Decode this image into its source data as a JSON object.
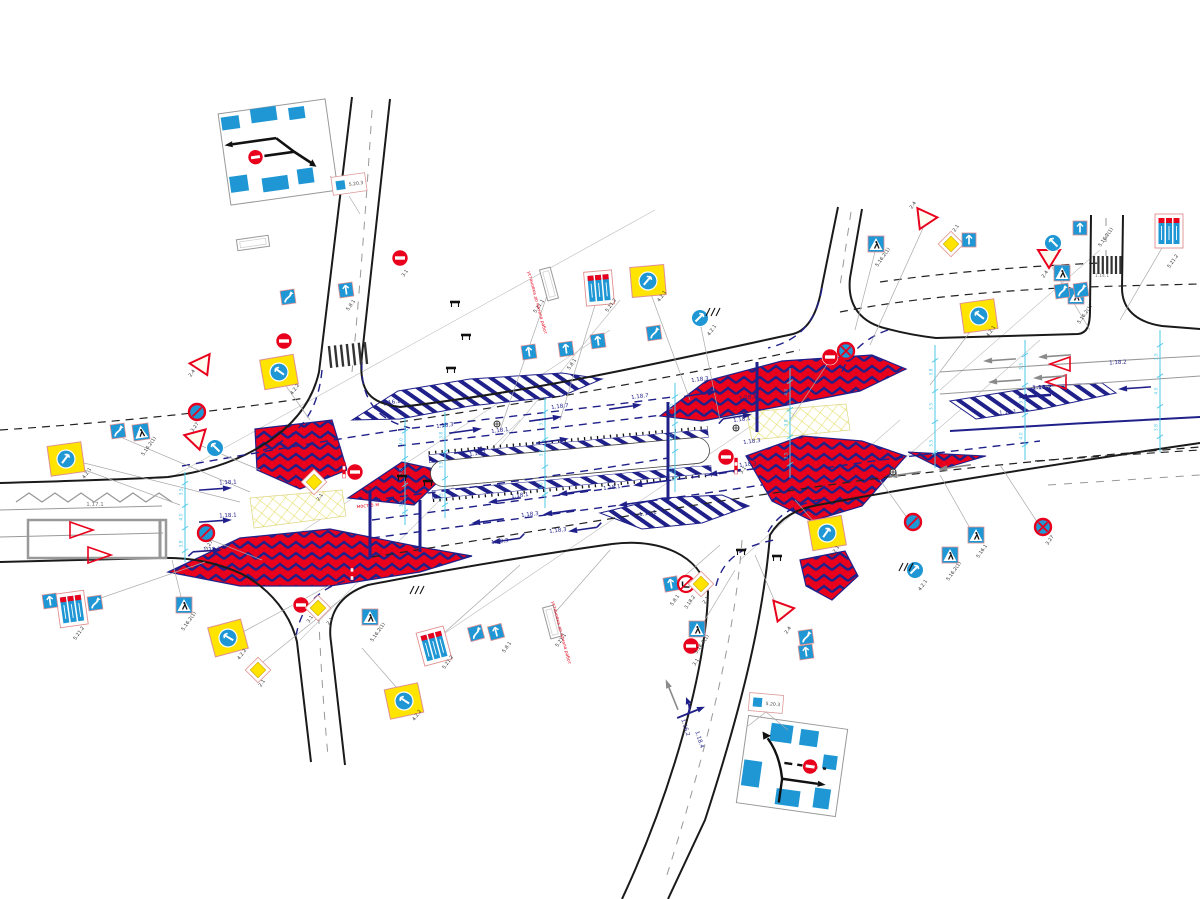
{
  "colors": {
    "navy": "#20208a",
    "red": "#e8001c",
    "yellow": "#ffe400",
    "sign_blue": "#1f97d4",
    "cyan": "#4ec8e8",
    "gray": "#8a8a8a"
  },
  "insets": {
    "top_left": {
      "code": "5.20.3"
    },
    "bottom_right": {
      "code": "5.20.3"
    }
  },
  "notes": [
    {
      "t": "мост 5 м",
      "x": 368,
      "y": 507,
      "c": "r",
      "r": -6,
      "s": 5
    },
    {
      "t": "мост 5 м",
      "x": 320,
      "y": 572,
      "c": "r",
      "r": -6,
      "s": 5
    },
    {
      "t": "установка до начала работ",
      "x": 560,
      "y": 633,
      "c": "r",
      "r": 75,
      "s": 4.5
    },
    {
      "t": "установка до начала работ",
      "x": 536,
      "y": 303,
      "c": "r",
      "r": 75,
      "s": 4.5
    }
  ],
  "signs": [
    {
      "t": "wv",
      "c": "5.8.1",
      "x": 288,
      "y": 297,
      "r": -8
    },
    {
      "t": "ba",
      "c": "5.8.1",
      "x": 346,
      "y": 290,
      "r": -8
    },
    {
      "t": "ne",
      "c": "3.1",
      "x": 400,
      "y": 258
    },
    {
      "t": "ne",
      "c": "3.1",
      "x": 284,
      "y": 341
    },
    {
      "t": "gw",
      "c": "2.4",
      "x": 203,
      "y": 366,
      "r": -25
    },
    {
      "t": "bs",
      "c": "3.27",
      "x": 197,
      "y": 412
    },
    {
      "t": "gw",
      "c": "2.4",
      "x": 197,
      "y": 440,
      "r": -15
    },
    {
      "t": "bc",
      "c": "4.2.2",
      "x": 215,
      "y": 448,
      "d": "left"
    },
    {
      "t": "yb",
      "c": "4.2.2",
      "x": 279,
      "y": 372,
      "r": -10,
      "d": "left"
    },
    {
      "t": "ped",
      "c": "5.16.2(1)",
      "x": 141,
      "y": 432,
      "r": -8
    },
    {
      "t": "yb",
      "c": "4.2.1",
      "x": 66,
      "y": 459,
      "r": -8,
      "d": "right"
    },
    {
      "t": "bs",
      "c": "3.27",
      "x": 206,
      "y": 533
    },
    {
      "t": "wv",
      "c": "5.8.1",
      "x": 118,
      "y": 431,
      "r": -8
    },
    {
      "t": "p3",
      "c": "5.21.2",
      "x": 72,
      "y": 609,
      "r": -8
    },
    {
      "t": "wv",
      "c": "5.8.1",
      "x": 95,
      "y": 603,
      "r": -8
    },
    {
      "t": "ba",
      "c": "5.8.1",
      "x": 50,
      "y": 601,
      "r": -8
    },
    {
      "t": "ped",
      "c": "5.16.2(1)",
      "x": 184,
      "y": 605
    },
    {
      "t": "yb",
      "c": "4.2.2",
      "x": 228,
      "y": 638,
      "r": -15,
      "d": "left"
    },
    {
      "t": "dia",
      "c": "2.1",
      "x": 258,
      "y": 670
    },
    {
      "t": "ne",
      "c": "3.1",
      "x": 301,
      "y": 605
    },
    {
      "t": "dia",
      "c": "2.1",
      "x": 318,
      "y": 608
    },
    {
      "t": "yb",
      "c": "4.2.2",
      "x": 404,
      "y": 701,
      "r": -12,
      "d": "left"
    },
    {
      "t": "ped",
      "c": "5.16.2(1)",
      "x": 370,
      "y": 617
    },
    {
      "t": "p3",
      "c": "5.21.2",
      "x": 434,
      "y": 646,
      "r": -15
    },
    {
      "t": "wv",
      "c": "5.8.1",
      "x": 476,
      "y": 633,
      "r": -15
    },
    {
      "t": "ba",
      "c": "5.8.1",
      "x": 496,
      "y": 632,
      "r": -15
    },
    {
      "t": "wb",
      "c": "5.21.1",
      "x": 552,
      "y": 622,
      "r": 75
    },
    {
      "t": "ne",
      "c": "3.1",
      "x": 355,
      "y": 472
    },
    {
      "t": "post",
      "x": 344,
      "y": 470
    },
    {
      "t": "post",
      "x": 352,
      "y": 572
    },
    {
      "t": "dia",
      "c": "2.1",
      "x": 314,
      "y": 482
    },
    {
      "t": "wb",
      "c": "5.21.1",
      "x": 549,
      "y": 284,
      "r": 75
    },
    {
      "t": "p3",
      "c": "5.21.2",
      "x": 599,
      "y": 288,
      "r": -5
    },
    {
      "t": "yb",
      "c": "4.2.1",
      "x": 648,
      "y": 281,
      "r": -5,
      "d": "right"
    },
    {
      "t": "ba",
      "c": "5.8.1",
      "x": 529,
      "y": 352,
      "r": -8
    },
    {
      "t": "ba",
      "c": "5.8.1",
      "x": 566,
      "y": 349,
      "r": -8
    },
    {
      "t": "ba",
      "c": "5.8.1",
      "x": 598,
      "y": 341,
      "r": -8
    },
    {
      "t": "wv",
      "c": "5.8.1",
      "x": 654,
      "y": 333,
      "r": -8
    },
    {
      "t": "bc",
      "c": "4.2.1",
      "x": 700,
      "y": 318,
      "d": "right"
    },
    {
      "t": "ne",
      "c": "3.1",
      "x": 830,
      "y": 357
    },
    {
      "t": "ns",
      "c": "3.27",
      "x": 846,
      "y": 351
    },
    {
      "t": "ped",
      "c": "5.16.2(1)",
      "x": 876,
      "y": 244
    },
    {
      "t": "gw",
      "c": "2.4",
      "x": 924,
      "y": 220,
      "r": 25
    },
    {
      "t": "dia",
      "c": "2.1",
      "x": 951,
      "y": 244
    },
    {
      "t": "ba",
      "c": "5.8.1",
      "x": 969,
      "y": 240
    },
    {
      "t": "gw",
      "c": "2.4",
      "x": 1049,
      "y": 258
    },
    {
      "t": "bc",
      "c": "4.2.2",
      "x": 1053,
      "y": 243,
      "d": "left"
    },
    {
      "t": "ba",
      "c": "5.8.1",
      "x": 1080,
      "y": 228
    },
    {
      "t": "ped",
      "c": "5.16.2(1)",
      "x": 1062,
      "y": 273
    },
    {
      "t": "ped",
      "c": "5.16.2(1)",
      "x": 1076,
      "y": 296
    },
    {
      "t": "p3",
      "c": "5.21.2",
      "x": 1169,
      "y": 231
    },
    {
      "t": "yb",
      "c": "4.2.1",
      "x": 979,
      "y": 316,
      "r": -8,
      "d": "left"
    },
    {
      "t": "wv",
      "c": "5.8.1",
      "x": 1062,
      "y": 291,
      "r": -8
    },
    {
      "t": "wv",
      "c": "5.8.1",
      "x": 1081,
      "y": 290,
      "r": -8
    },
    {
      "t": "ne",
      "c": "3.1",
      "x": 726,
      "y": 457
    },
    {
      "t": "post",
      "x": 736,
      "y": 466
    },
    {
      "t": "yb",
      "c": "4.2.1",
      "x": 827,
      "y": 533,
      "r": -10,
      "d": "right"
    },
    {
      "t": "bs",
      "c": "3.27",
      "x": 913,
      "y": 522
    },
    {
      "t": "bc",
      "c": "4.2.1",
      "x": 915,
      "y": 570,
      "d": "right"
    },
    {
      "t": "ped",
      "c": "5.16.1",
      "x": 976,
      "y": 535
    },
    {
      "t": "ped",
      "c": "5.16.2(1)",
      "x": 950,
      "y": 555
    },
    {
      "t": "ns",
      "c": "3.27",
      "x": 1043,
      "y": 527
    },
    {
      "t": "ba",
      "c": "5.8.1",
      "x": 671,
      "y": 584,
      "r": -10
    },
    {
      "t": "nt",
      "c": "3.18.2",
      "x": 686,
      "y": 584
    },
    {
      "t": "dia",
      "c": "2.1",
      "x": 701,
      "y": 584
    },
    {
      "t": "ped",
      "c": "5.16.2(1)",
      "x": 697,
      "y": 629
    },
    {
      "t": "ne",
      "c": "3.1",
      "x": 691,
      "y": 646
    },
    {
      "t": "gw",
      "c": "2.4",
      "x": 781,
      "y": 612,
      "r": 20
    },
    {
      "t": "wv",
      "c": "5.8.1",
      "x": 806,
      "y": 637,
      "r": -8
    },
    {
      "t": "ba",
      "c": "5.8.1",
      "x": 806,
      "y": 652,
      "r": -8
    },
    {
      "t": "bar",
      "x": 741,
      "y": 551
    },
    {
      "t": "bar",
      "x": 777,
      "y": 557
    },
    {
      "t": "bar",
      "x": 455,
      "y": 303
    },
    {
      "t": "bar",
      "x": 466,
      "y": 336
    },
    {
      "t": "bar",
      "x": 451,
      "y": 369
    },
    {
      "t": "bar",
      "x": 402,
      "y": 477
    },
    {
      "t": "bar",
      "x": 428,
      "y": 482
    },
    {
      "t": "hm",
      "x": 712,
      "y": 312
    },
    {
      "t": "hm",
      "x": 905,
      "y": 567
    },
    {
      "t": "hm",
      "x": 416,
      "y": 590
    },
    {
      "t": "cbx",
      "c": "5.20.3",
      "x": 349,
      "y": 184,
      "r": -8
    },
    {
      "t": "cbx",
      "c": "5.20.3",
      "x": 766,
      "y": 703,
      "r": 5
    },
    {
      "t": "sig",
      "x": 497,
      "y": 424
    },
    {
      "t": "sig",
      "x": 736,
      "y": 428
    },
    {
      "t": "sig",
      "x": 893,
      "y": 472
    },
    {
      "t": "wb",
      "c": "5.21.2",
      "x": 253,
      "y": 243,
      "r": -8
    }
  ],
  "labels": [
    {
      "t": "1.18.1",
      "x": 500,
      "y": 432,
      "c": "n",
      "r": -7
    },
    {
      "t": "1.18.1",
      "x": 478,
      "y": 455,
      "c": "n",
      "r": -7
    },
    {
      "t": "1.18.1",
      "x": 748,
      "y": 399,
      "c": "n",
      "r": -7
    },
    {
      "t": "1.18.1",
      "x": 742,
      "y": 421,
      "c": "n",
      "r": -7
    },
    {
      "t": "1.18.1",
      "x": 520,
      "y": 497,
      "c": "n",
      "r": -7
    },
    {
      "t": "1.18.1",
      "x": 612,
      "y": 489,
      "c": "n",
      "r": -7
    },
    {
      "t": "1.18.1",
      "x": 228,
      "y": 484,
      "c": "n",
      "r": -3
    },
    {
      "t": "1.18.1",
      "x": 228,
      "y": 517,
      "c": "n",
      "r": -3
    },
    {
      "t": "1.18.3",
      "x": 700,
      "y": 381,
      "c": "n",
      "r": -7
    },
    {
      "t": "1.18.3",
      "x": 752,
      "y": 443,
      "c": "n",
      "r": -7
    },
    {
      "t": "1.18.3",
      "x": 748,
      "y": 466,
      "c": "n",
      "r": -7
    },
    {
      "t": "1.18.3",
      "x": 530,
      "y": 516,
      "c": "n",
      "r": -7
    },
    {
      "t": "1.18.3",
      "x": 558,
      "y": 532,
      "c": "n",
      "r": -7
    },
    {
      "t": "1.18.3",
      "x": 500,
      "y": 543,
      "c": "n",
      "r": -7
    },
    {
      "t": "1.18.3",
      "x": 445,
      "y": 427,
      "c": "n",
      "r": -7
    },
    {
      "t": "1.18.7",
      "x": 560,
      "y": 408,
      "c": "n",
      "r": -7
    },
    {
      "t": "1.18.7",
      "x": 640,
      "y": 398,
      "c": "n",
      "r": -7
    },
    {
      "t": "1.18.2",
      "x": 212,
      "y": 551,
      "c": "n",
      "r": -3
    },
    {
      "t": "1.18.2",
      "x": 1042,
      "y": 389,
      "c": "n",
      "r": -3,
      "b": true
    },
    {
      "t": "1.18.2",
      "x": 1118,
      "y": 364,
      "c": "n",
      "r": -3
    },
    {
      "t": "1.16.2",
      "x": 684,
      "y": 728,
      "c": "n",
      "r": 72
    },
    {
      "t": "1.18.4",
      "x": 698,
      "y": 740,
      "c": "n",
      "r": 72
    },
    {
      "t": "1.16.1",
      "x": 1008,
      "y": 414,
      "c": "n",
      "r": -5
    },
    {
      "t": "1.16.1",
      "x": 648,
      "y": 515,
      "c": "n",
      "r": -7
    },
    {
      "t": "1.16.1",
      "x": 392,
      "y": 404,
      "c": "n",
      "r": -10
    },
    {
      "t": "1.17.1",
      "x": 95,
      "y": 506,
      "c": "g"
    },
    {
      "t": "1.14.1",
      "x": 1102,
      "y": 277,
      "c": "g",
      "s": 4.5
    },
    {
      "t": "4.2.1",
      "x": 88,
      "y": 474,
      "c": "k",
      "r": -55
    },
    {
      "t": "4.2.2",
      "x": 296,
      "y": 390,
      "c": "k",
      "r": -55
    },
    {
      "t": "2.4",
      "x": 193,
      "y": 374,
      "c": "k",
      "r": -55
    },
    {
      "t": "3.27",
      "x": 210,
      "y": 546,
      "c": "k",
      "r": -55
    },
    {
      "t": "3.27",
      "x": 196,
      "y": 428,
      "c": "k",
      "r": -55
    },
    {
      "t": "5.16.2(1)",
      "x": 150,
      "y": 447,
      "c": "k",
      "r": -55
    },
    {
      "t": "5.16.2(1)",
      "x": 190,
      "y": 622,
      "c": "k",
      "r": -55
    },
    {
      "t": "5.21.2",
      "x": 80,
      "y": 634,
      "c": "k",
      "r": -55
    },
    {
      "t": "4.2.2",
      "x": 243,
      "y": 655,
      "c": "k",
      "r": -55
    },
    {
      "t": "2.1",
      "x": 263,
      "y": 684,
      "c": "k",
      "r": -55
    },
    {
      "t": "3.1",
      "x": 311,
      "y": 620,
      "c": "k",
      "r": -55
    },
    {
      "t": "2.1",
      "x": 331,
      "y": 622,
      "c": "k",
      "r": -55
    },
    {
      "t": "4.2.2",
      "x": 418,
      "y": 716,
      "c": "k",
      "r": -55
    },
    {
      "t": "5.16.2(1)",
      "x": 379,
      "y": 633,
      "c": "k",
      "r": -55
    },
    {
      "t": "5.21.2",
      "x": 449,
      "y": 663,
      "c": "k",
      "r": -55
    },
    {
      "t": "5.8.1",
      "x": 508,
      "y": 648,
      "c": "k",
      "r": -55
    },
    {
      "t": "5.21.1",
      "x": 562,
      "y": 641,
      "c": "k",
      "r": -55
    },
    {
      "t": "5.21.1",
      "x": 540,
      "y": 307,
      "c": "k",
      "r": -55
    },
    {
      "t": "5.21.2",
      "x": 612,
      "y": 306,
      "c": "k",
      "r": -55
    },
    {
      "t": "4.2.1",
      "x": 663,
      "y": 297,
      "c": "k",
      "r": -55
    },
    {
      "t": "5.8.1",
      "x": 352,
      "y": 306,
      "c": "k",
      "r": -55
    },
    {
      "t": "5.8.1",
      "x": 573,
      "y": 365,
      "c": "k",
      "r": -55
    },
    {
      "t": "4.2.1",
      "x": 713,
      "y": 331,
      "c": "k",
      "r": -55
    },
    {
      "t": "3.1",
      "x": 744,
      "y": 471,
      "c": "k",
      "r": -55
    },
    {
      "t": "3.1",
      "x": 406,
      "y": 274,
      "c": "k",
      "r": -55
    },
    {
      "t": "3.1",
      "x": 369,
      "y": 490,
      "c": "k",
      "r": -55
    },
    {
      "t": "2.1",
      "x": 321,
      "y": 498,
      "c": "k",
      "r": -55
    },
    {
      "t": "5.16.2(1)",
      "x": 884,
      "y": 258,
      "c": "k",
      "r": -55
    },
    {
      "t": "2.4",
      "x": 914,
      "y": 206,
      "c": "k",
      "r": -55
    },
    {
      "t": "2.1",
      "x": 957,
      "y": 229,
      "c": "k",
      "r": -55
    },
    {
      "t": "2.4",
      "x": 1046,
      "y": 275,
      "c": "k",
      "r": -55
    },
    {
      "t": "5.16.2(1)",
      "x": 1107,
      "y": 238,
      "c": "k",
      "r": -55
    },
    {
      "t": "5.16.2(1)",
      "x": 1086,
      "y": 315,
      "c": "k",
      "r": -55
    },
    {
      "t": "5.21.2",
      "x": 1174,
      "y": 262,
      "c": "k",
      "r": -55
    },
    {
      "t": "4.2.1",
      "x": 992,
      "y": 332,
      "c": "k",
      "r": -55
    },
    {
      "t": "4.2.1",
      "x": 836,
      "y": 552,
      "c": "k",
      "r": -55
    },
    {
      "t": "4.2.1",
      "x": 924,
      "y": 586,
      "c": "k",
      "r": -55
    },
    {
      "t": "3.27",
      "x": 1051,
      "y": 541,
      "c": "k",
      "r": -55
    },
    {
      "t": "5.16.1",
      "x": 983,
      "y": 552,
      "c": "k",
      "r": -55
    },
    {
      "t": "5.16.2(1)",
      "x": 955,
      "y": 572,
      "c": "k",
      "r": -55
    },
    {
      "t": "5.8.1",
      "x": 676,
      "y": 601,
      "c": "k",
      "r": -55
    },
    {
      "t": "3.18.2",
      "x": 691,
      "y": 603,
      "c": "k",
      "r": -55
    },
    {
      "t": "2.1",
      "x": 707,
      "y": 601,
      "c": "k",
      "r": -55
    },
    {
      "t": "5.16.2(1)",
      "x": 703,
      "y": 645,
      "c": "k",
      "r": -55
    },
    {
      "t": "3.1",
      "x": 697,
      "y": 663,
      "c": "k",
      "r": -55
    },
    {
      "t": "2.4",
      "x": 789,
      "y": 631,
      "c": "k",
      "r": -55
    }
  ],
  "lane_arrows": [
    {
      "x": 465,
      "y": 431,
      "r": -8,
      "s": "st",
      "c": "n"
    },
    {
      "x": 545,
      "y": 419,
      "r": -8,
      "s": "st",
      "c": "n"
    },
    {
      "x": 625,
      "y": 407,
      "r": -8,
      "s": "st",
      "c": "n"
    },
    {
      "x": 470,
      "y": 451,
      "r": -8,
      "s": "st",
      "c": "n"
    },
    {
      "x": 552,
      "y": 441,
      "r": -8,
      "s": "st",
      "c": "n"
    },
    {
      "x": 700,
      "y": 394,
      "r": -9,
      "s": "st",
      "c": "n"
    },
    {
      "x": 735,
      "y": 417,
      "r": -9,
      "s": "bt",
      "c": "n"
    },
    {
      "x": 215,
      "y": 489,
      "r": -4,
      "s": "st",
      "c": "n"
    },
    {
      "x": 215,
      "y": 521,
      "r": -4,
      "s": "st",
      "c": "n"
    },
    {
      "x": 205,
      "y": 551,
      "r": -4,
      "s": "bt",
      "c": "n"
    },
    {
      "x": 505,
      "y": 500,
      "r": 172,
      "s": "st",
      "c": "n"
    },
    {
      "x": 575,
      "y": 492,
      "r": 172,
      "s": "st",
      "c": "n"
    },
    {
      "x": 650,
      "y": 483,
      "r": 172,
      "s": "st",
      "c": "n"
    },
    {
      "x": 725,
      "y": 472,
      "r": 171,
      "s": "st",
      "c": "n"
    },
    {
      "x": 488,
      "y": 521,
      "r": 172,
      "s": "st",
      "c": "n"
    },
    {
      "x": 560,
      "y": 512,
      "r": 172,
      "s": "st",
      "c": "n"
    },
    {
      "x": 635,
      "y": 503,
      "r": 172,
      "s": "st",
      "c": "n"
    },
    {
      "x": 508,
      "y": 540,
      "r": 172,
      "s": "bt",
      "c": "n"
    },
    {
      "x": 585,
      "y": 529,
      "r": 172,
      "s": "bt",
      "c": "n"
    },
    {
      "x": 1035,
      "y": 396,
      "r": 176,
      "s": "st",
      "c": "b"
    },
    {
      "x": 1135,
      "y": 388,
      "r": 176,
      "s": "st",
      "c": "n"
    },
    {
      "x": 1000,
      "y": 360,
      "r": 176,
      "s": "st",
      "c": "g"
    },
    {
      "x": 1055,
      "y": 356,
      "r": 176,
      "s": "st",
      "c": "g"
    },
    {
      "x": 1005,
      "y": 381,
      "r": 176,
      "s": "st",
      "c": "g"
    },
    {
      "x": 1050,
      "y": 377,
      "r": 176,
      "s": "st",
      "c": "g"
    },
    {
      "x": 905,
      "y": 474,
      "r": 172,
      "s": "st",
      "c": "g"
    },
    {
      "x": 955,
      "y": 467,
      "r": 172,
      "s": "st",
      "c": "g"
    },
    {
      "x": 692,
      "y": 712,
      "r": 68,
      "s": "cb",
      "c": "n"
    },
    {
      "x": 672,
      "y": 695,
      "r": -112,
      "s": "st",
      "c": "g"
    }
  ],
  "dimensions": {
    "values": [
      "3.5",
      "4.0",
      "3.8",
      "3.5"
    ],
    "lines": [
      {
        "x": 185,
        "y1": 472,
        "y2": 562
      },
      {
        "x": 405,
        "y1": 418,
        "y2": 525
      },
      {
        "x": 445,
        "y1": 412,
        "y2": 518
      },
      {
        "x": 545,
        "y1": 398,
        "y2": 508
      },
      {
        "x": 675,
        "y1": 383,
        "y2": 492
      },
      {
        "x": 790,
        "y1": 368,
        "y2": 478
      },
      {
        "x": 935,
        "y1": 345,
        "y2": 468
      },
      {
        "x": 1025,
        "y1": 340,
        "y2": 460
      },
      {
        "x": 1160,
        "y1": 330,
        "y2": 452
      }
    ]
  }
}
